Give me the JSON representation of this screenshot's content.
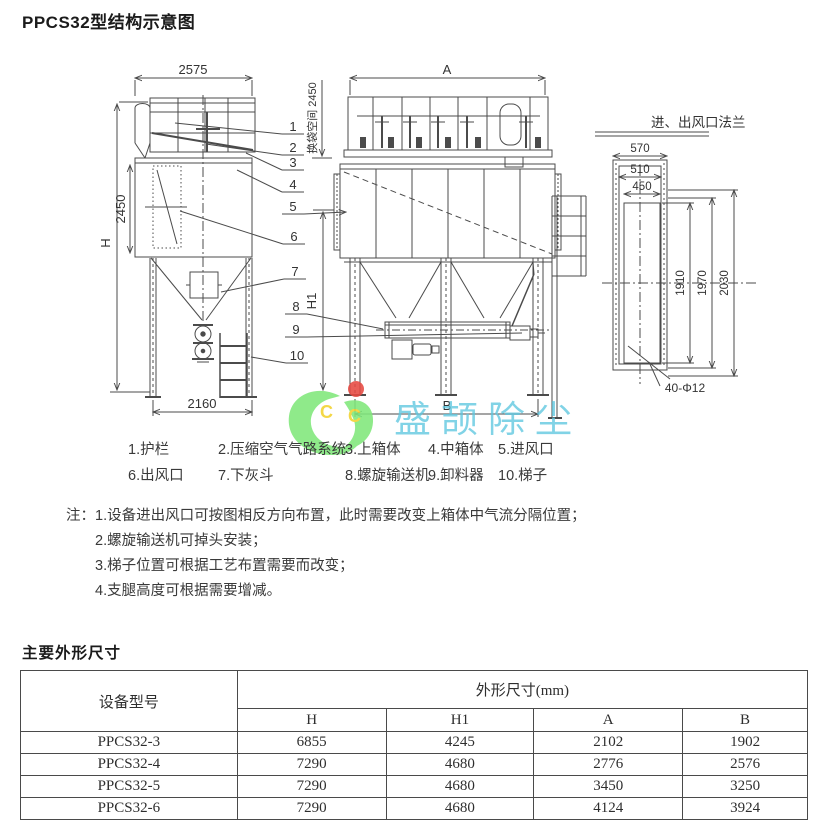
{
  "page": {
    "title": "PPCS32型结构示意图",
    "section2_title": "主要外形尺寸"
  },
  "drawing": {
    "left": {
      "width": "2575",
      "height": "H",
      "body_height": "2450",
      "base_width": "2160",
      "bag_space": "换袋空间 2450"
    },
    "center": {
      "width": "A",
      "height": "H1",
      "base_width": "B"
    },
    "flange": {
      "title": "进、出风口法兰",
      "w_outer": "570",
      "w_bolt": "510",
      "w_open": "450",
      "h_open": "1910",
      "h_bolt": "1970",
      "h_outer": "2030",
      "bolts": "40-Φ12"
    },
    "callouts": [
      "1",
      "2",
      "3",
      "4",
      "5",
      "6",
      "7",
      "8",
      "9",
      "10"
    ]
  },
  "legend": {
    "rows": [
      [
        "1.护栏",
        "2.压缩空气气路系统",
        "3.上箱体",
        "4.中箱体",
        "5.进风口"
      ],
      [
        "6.出风口",
        "7.下灰斗",
        "8.螺旋输送机",
        "9.卸料器",
        "10.梯子"
      ]
    ]
  },
  "notes": {
    "label": "注：",
    "items": [
      "1.设备进出风口可按图相反方向布置，此时需要改变上箱体中气流分隔位置；",
      "2.螺旋输送机可掉头安装；",
      "3.梯子位置可根据工艺布置需要而改变；",
      "4.支腿高度可根据需要增减。"
    ]
  },
  "watermark": {
    "text": "盛颉除尘",
    "logo_letters": [
      "C",
      "C"
    ],
    "logo_green": "#80e87b",
    "logo_red": "#e74a42",
    "logo_yellow": "#f2d22e",
    "text_color": "#5ec7e0"
  },
  "table": {
    "col0_header": "设备型号",
    "group_header": "外形尺寸(mm)",
    "sub_headers": [
      "H",
      "H1",
      "A",
      "B"
    ],
    "rows": [
      {
        "model": "PPCS32-3",
        "values": [
          "6855",
          "4245",
          "2102",
          "1902"
        ]
      },
      {
        "model": "PPCS32-4",
        "values": [
          "7290",
          "4680",
          "2776",
          "2576"
        ]
      },
      {
        "model": "PPCS32-5",
        "values": [
          "7290",
          "4680",
          "3450",
          "3250"
        ]
      },
      {
        "model": "PPCS32-6",
        "values": [
          "7290",
          "4680",
          "4124",
          "3924"
        ]
      }
    ]
  }
}
